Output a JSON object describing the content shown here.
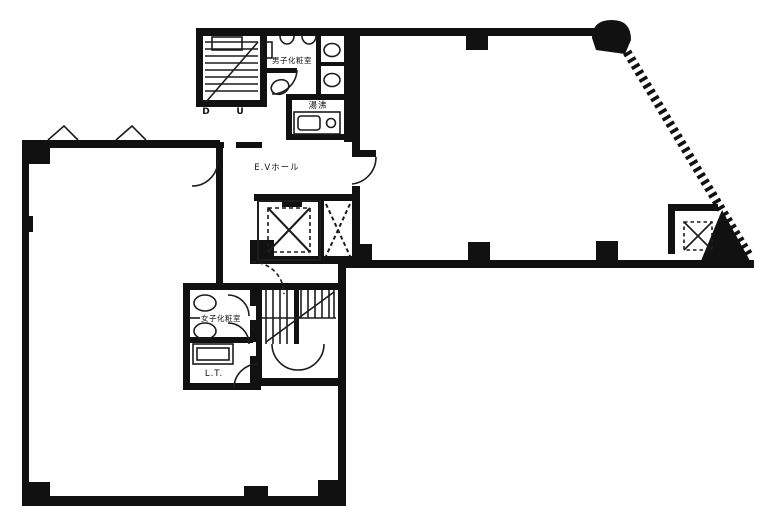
{
  "floorplan": {
    "kind": "building-floor-plan",
    "labels": {
      "mens_restroom": "男子化粧室",
      "kitchenette": "湯沸",
      "elevator_hall": "E.Vホール",
      "womens_restroom": "女子化粧室",
      "utility_room": "L.T.",
      "stair_down": "D",
      "stair_up": "U"
    },
    "colors": {
      "wall": "#111111",
      "line": "#1c1c1c",
      "background": "#ffffff"
    }
  }
}
